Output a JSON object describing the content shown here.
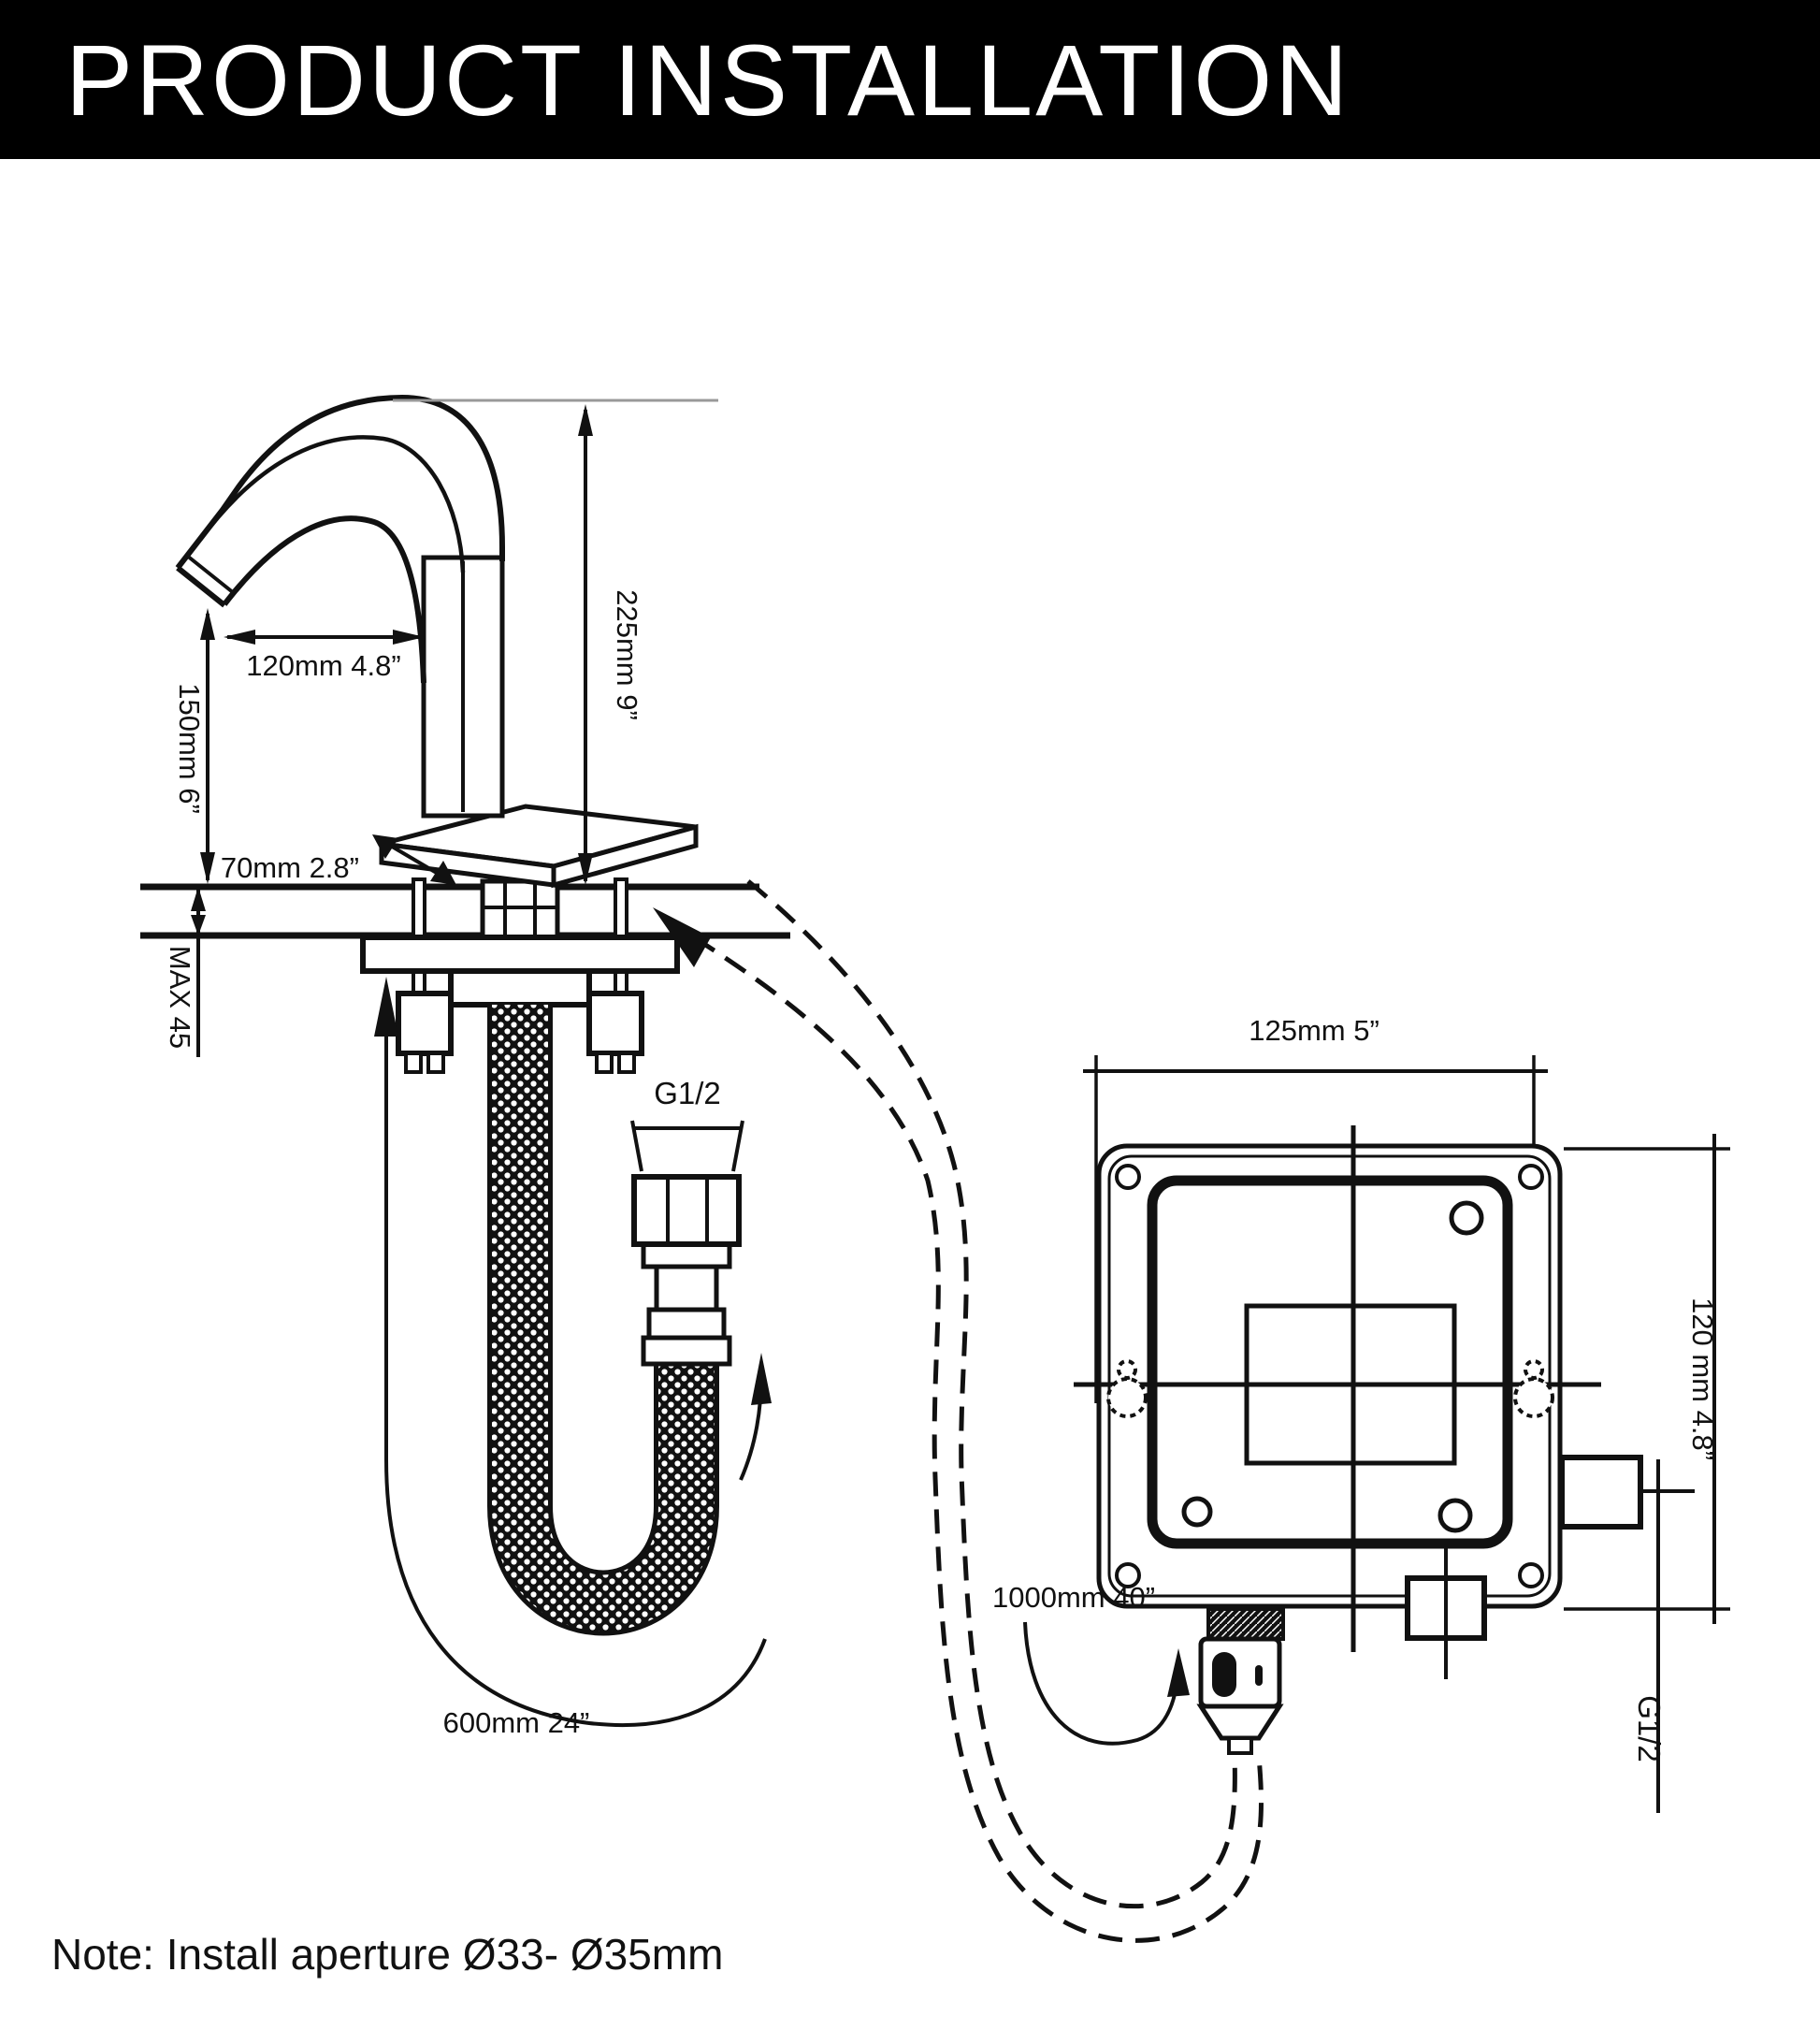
{
  "header": {
    "title": "PRODUCT INSTALLATION"
  },
  "note": {
    "text": "Note: Install aperture Ø33- Ø35mm"
  },
  "colors": {
    "ink": "#111111",
    "background": "#ffffff",
    "header_bg": "#000000",
    "header_text": "#ffffff"
  },
  "faucet": {
    "labels": {
      "spout_reach": "120mm 4.8”",
      "spout_height": "225mm 9”",
      "outlet_height": "150mm 6”",
      "base_width": "70mm 2.8”",
      "max_counter_thickness": "MAX 45",
      "supply_hose_thread": "G1/2",
      "supply_hose_length": "600mm 24”"
    }
  },
  "control_box": {
    "labels": {
      "box_width": "125mm 5”",
      "box_height": "120 mm 4.8”",
      "outlet_thread": "G1/2",
      "sensor_cable_length": "1000mm 40”"
    }
  }
}
